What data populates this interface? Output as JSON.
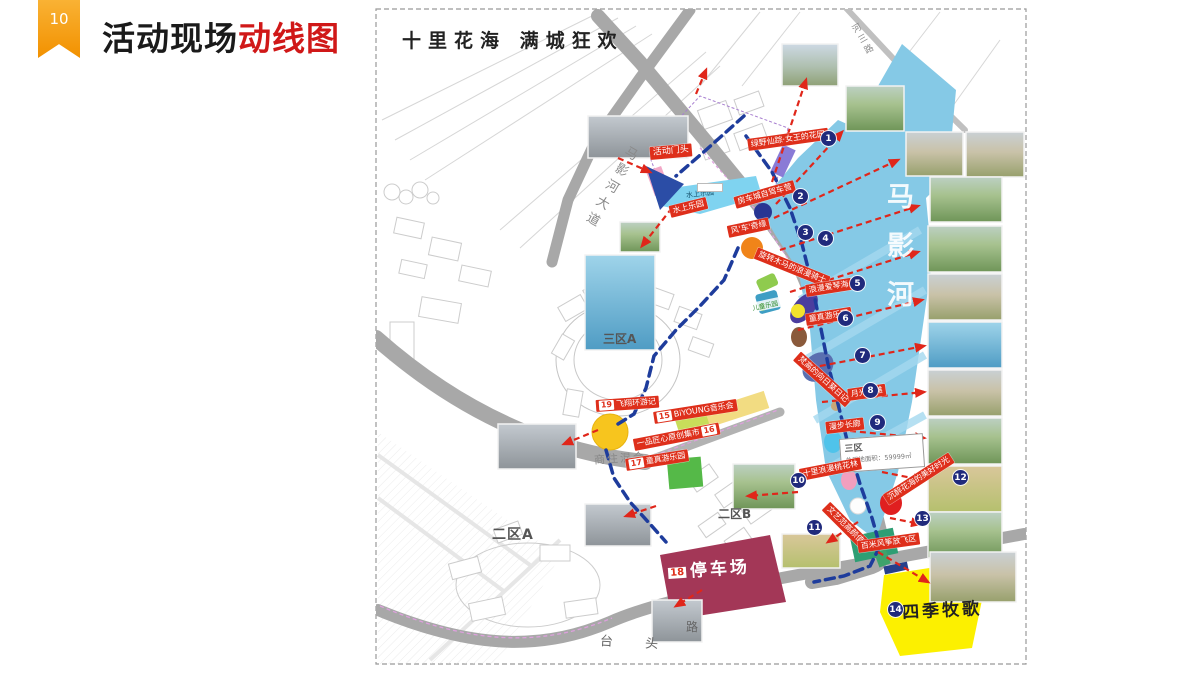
{
  "slide": {
    "page_number": "10",
    "title": {
      "black": "活动现场",
      "red": "动线图"
    }
  },
  "map": {
    "banner_title": "十里花海 满城狂欢",
    "river_name": "马影河",
    "road_names": {
      "left_avenue": "马影河大道",
      "top_right": "河三路",
      "bottom_left": "台 头",
      "bottom_char": "路"
    },
    "zone_labels": {
      "a": "二区A",
      "b": "二区B",
      "c": "三区A",
      "land_use": "商住混合"
    },
    "area_box": {
      "zone": "三区",
      "line": "总用地面积：",
      "value": "59999㎡"
    },
    "entrance_label": "活动门头",
    "water_park_red_label": "水上乐园",
    "water_park_area_label": "水上乐园",
    "kids_chip_label": "儿童乐园",
    "stops": [
      {
        "num": "1",
        "label": "绿野仙踪·女王的花园"
      },
      {
        "num": "2",
        "label": "房车城自驾车营"
      },
      {
        "num": "3",
        "label": "风'车'奇缘"
      },
      {
        "num": "4",
        "label": "旋转木马的浪漫骑士"
      },
      {
        "num": "5",
        "label": "浪漫爱琴海"
      },
      {
        "num": "6",
        "label": "童真游乐园"
      },
      {
        "num": "7",
        "label": "梵高的向日葵日记"
      },
      {
        "num": "8",
        "label": "月光沙滩"
      },
      {
        "num": "9",
        "label": "漫步长廊"
      },
      {
        "num": "10",
        "label": "十里浪漫桃花林"
      },
      {
        "num": "11",
        "label": "文艺范高颜值"
      },
      {
        "num": "12",
        "label": "沉醉花海的美好时光"
      },
      {
        "num": "13",
        "label": "百米风筝放飞区"
      },
      {
        "num": "14",
        "label": "四季牧歌"
      }
    ],
    "route_stops": [
      {
        "num": "15",
        "label": "BiYOUNG音乐会"
      },
      {
        "num": "16",
        "label": "一品匠心原创集市"
      },
      {
        "num": "17",
        "label": "童真游乐园"
      },
      {
        "num": "18",
        "label": "停车场"
      },
      {
        "num": "19",
        "label": "飞翔环游记"
      }
    ]
  },
  "colors": {
    "accent_orange": "#F29100",
    "title_red": "#D01818",
    "route_navy": "#1E3C9C",
    "arrow_red": "#E0261A",
    "river_blue": "#85C9E6",
    "parking_maroon": "#A33757",
    "pasture_yellow": "#FCF000"
  }
}
